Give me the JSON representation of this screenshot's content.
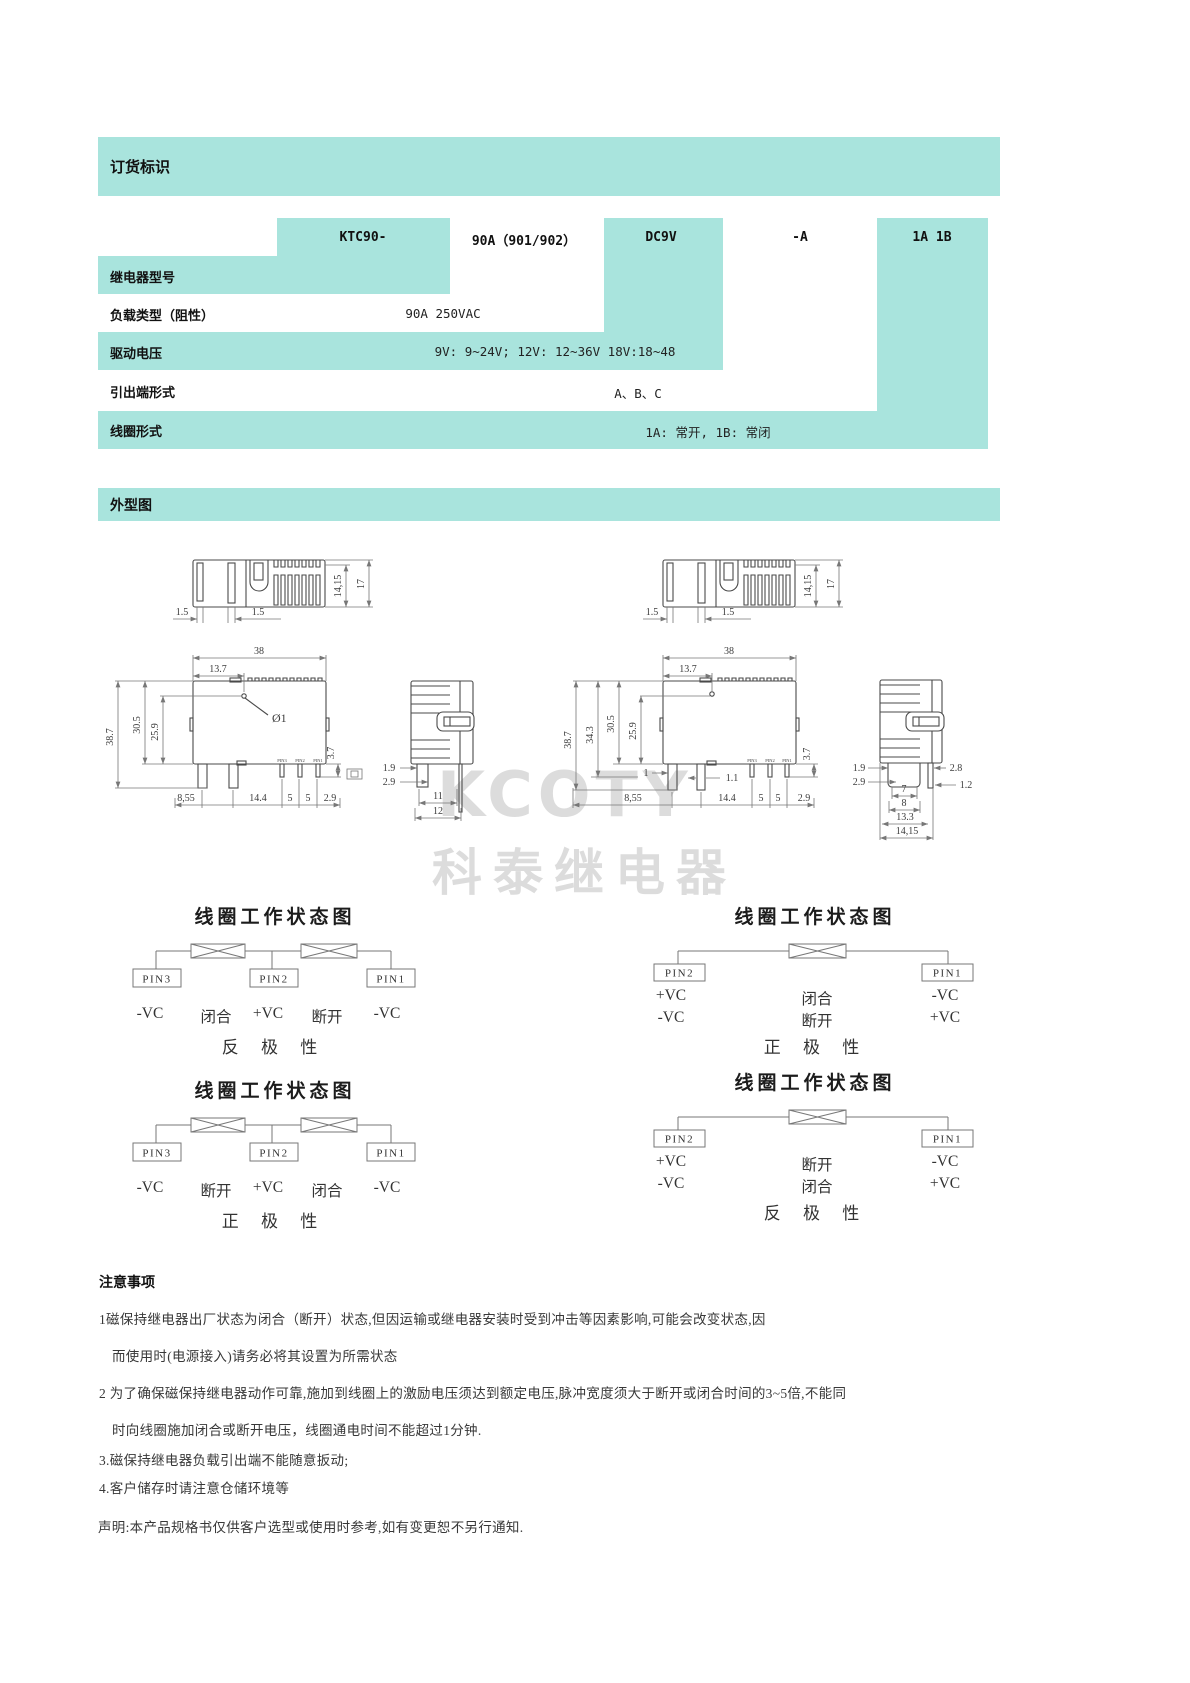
{
  "colors": {
    "accent": "#a9e4dd",
    "watermark_gray": "#dcdcdc",
    "line": "#4a4a4a"
  },
  "ordering": {
    "title": "订货标识",
    "code": [
      "KTC90-",
      "90A（901/902）",
      "DC9V",
      "-A",
      "1A 1B"
    ],
    "rows": [
      {
        "label": "继电器型号",
        "value": ""
      },
      {
        "label": "负载类型（阻性）",
        "value": "90A 250VAC"
      },
      {
        "label": "驱动电压",
        "value": "9V: 9~24V; 12V: 12~36V  18V:18~48"
      },
      {
        "label": "引出端形式",
        "value": "A、B、C"
      },
      {
        "label": "线圈形式",
        "value": "1A: 常开, 1B: 常闭"
      }
    ]
  },
  "outline": {
    "title": "外型图",
    "watermark": [
      "KCOTY",
      "科泰继电器"
    ],
    "lt": {
      "d1": "14,15",
      "d2": "17",
      "d3": "1.5",
      "d4": "1.5"
    },
    "lf": {
      "w": "38",
      "hx": "13.7",
      "hole": "Ø1",
      "v1": "38.7",
      "v2": "30.5",
      "v3": "25.9",
      "r1": "3.7",
      "b1": "8,55",
      "b2": "14.4",
      "b3": "5",
      "b4": "5",
      "b5": "2.9",
      "p1": "PIN3",
      "p2": "PIN2",
      "p3": "PIN1"
    },
    "ls": {
      "d1": "1.9",
      "d2": "2.9",
      "b1": "11",
      "b2": "12"
    },
    "rt": {
      "d1": "14,15",
      "d2": "17",
      "d3": "1.5",
      "d4": "1.5"
    },
    "rf": {
      "w": "38",
      "hx": "13.7",
      "v1": "38.7",
      "v2": "34.3",
      "v3": "30.5",
      "v4": "25.9",
      "i1": "1",
      "i2": "1.1",
      "r1": "3.7",
      "b1": "8,55",
      "b2": "14.4",
      "b3": "5",
      "b4": "5",
      "b5": "2.9",
      "p1": "PIN3",
      "p2": "PIN2",
      "p3": "PIN1"
    },
    "rs": {
      "d1": "1.9",
      "d2": "2.9",
      "d3": "2.8",
      "d4": "1.2",
      "b1": "7",
      "b2": "8",
      "b3": "13.3",
      "b4": "14,15"
    }
  },
  "diagrams": [
    {
      "title": "线圈工作状态图",
      "pins": [
        "PIN3",
        "PIN2",
        "PIN1"
      ],
      "row": [
        "-VC",
        "闭合",
        "+VC",
        "断开",
        "-VC"
      ],
      "pol": "反 极 性"
    },
    {
      "title": "线圈工作状态图",
      "pins": [
        "PIN2",
        "PIN1"
      ],
      "rows": [
        [
          "+VC",
          "闭合",
          "-VC"
        ],
        [
          "-VC",
          "断开",
          "+VC"
        ]
      ],
      "pol": "正 极 性"
    },
    {
      "title": "线圈工作状态图",
      "pins": [
        "PIN3",
        "PIN2",
        "PIN1"
      ],
      "row": [
        "-VC",
        "断开",
        "+VC",
        "闭合",
        "-VC"
      ],
      "pol": "正 极 性"
    },
    {
      "title": "线圈工作状态图",
      "pins": [
        "PIN2",
        "PIN1"
      ],
      "rows": [
        [
          "+VC",
          "断开",
          "-VC"
        ],
        [
          "-VC",
          "闭合",
          "+VC"
        ]
      ],
      "pol": "反 极 性"
    }
  ],
  "notes": {
    "title": "注意事项",
    "lines": [
      "1磁保持继电器出厂状态为闭合（断开）状态,但因运输或继电器安装时受到冲击等因素影响,可能会改变状态,因",
      "而使用时(电源接入)请务必将其设置为所需状态",
      "2 为了确保磁保持继电器动作可靠,施加到线圈上的激励电压须达到额定电压,脉冲宽度须大于断开或闭合时间的3~5倍,不能同",
      "时向线圈施加闭合或断开电压，线圈通电时间不能超过1分钟.",
      "3.磁保持继电器负载引出端不能随意扳动;",
      "4.客户储存时请注意仓储环境等",
      "声明:本产品规格书仅供客户选型或使用时参考,如有变更恕不另行通知."
    ]
  }
}
